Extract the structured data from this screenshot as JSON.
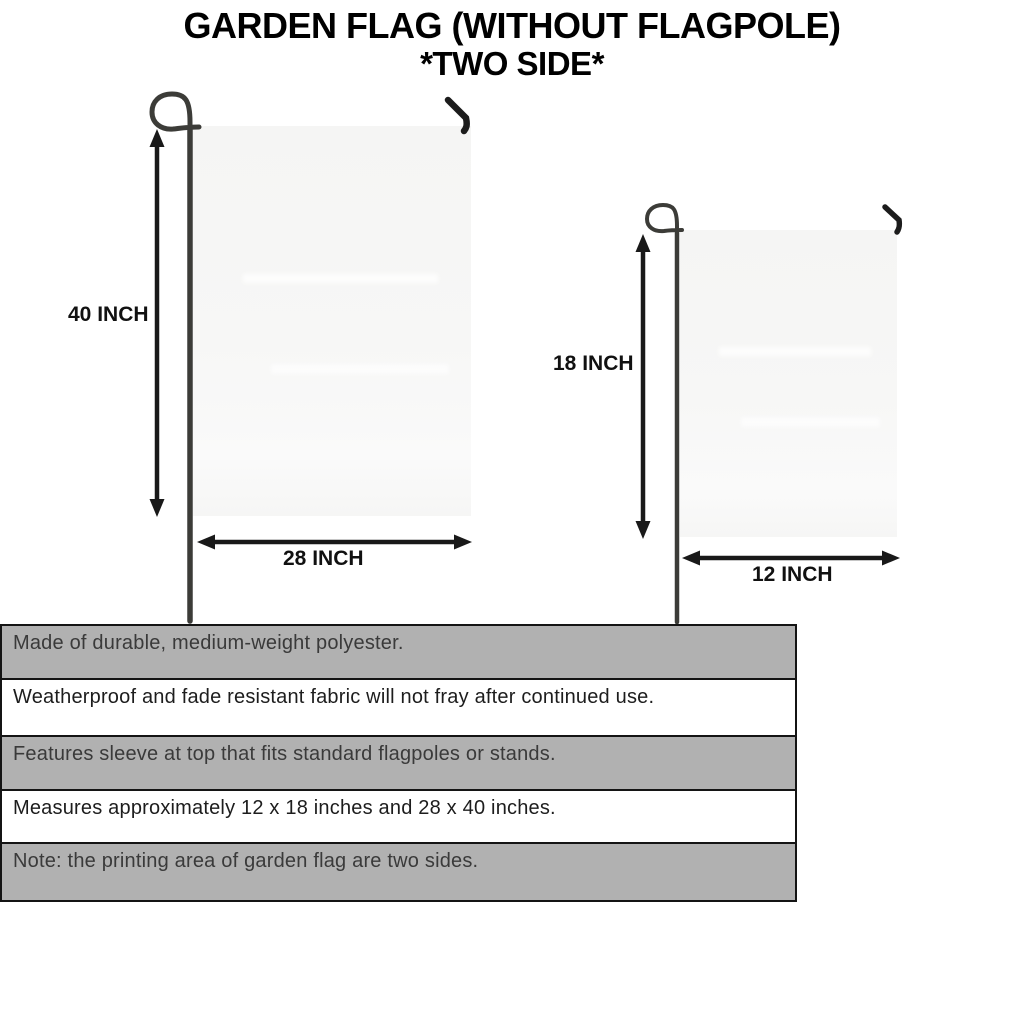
{
  "title": {
    "line1": "GARDEN FLAG (WITHOUT FLAGPOLE)",
    "line2": "*TWO SIDE*"
  },
  "diagrams": {
    "large_flag": {
      "name": "28 x 40 inch garden flag",
      "height_label": "40 INCH",
      "width_label": "28 INCH"
    },
    "small_flag": {
      "name": "12 x 18 inch garden flag",
      "height_label": "18 INCH",
      "width_label": "12 INCH"
    }
  },
  "features": [
    {
      "text": "Made of durable, medium-weight polyester.",
      "shaded": true
    },
    {
      "text": "Weatherproof and fade resistant fabric will not fray after continued use.",
      "shaded": false
    },
    {
      "text": "Features sleeve at top that fits standard flagpoles or stands.",
      "shaded": true
    },
    {
      "text": "Measures approximately 12 x 18 inches and 28 x 40 inches.",
      "shaded": false
    },
    {
      "text": "Note: the printing area of garden flag are two sides.",
      "shaded": true
    }
  ],
  "colors": {
    "row_shaded": "#b1b1b1",
    "row_plain": "#ffffff",
    "table_border": "#141414",
    "flag_fill": "#f6f6f5",
    "pole": "#3c3c38",
    "arrow": "#191919",
    "title_text": "#000000"
  }
}
